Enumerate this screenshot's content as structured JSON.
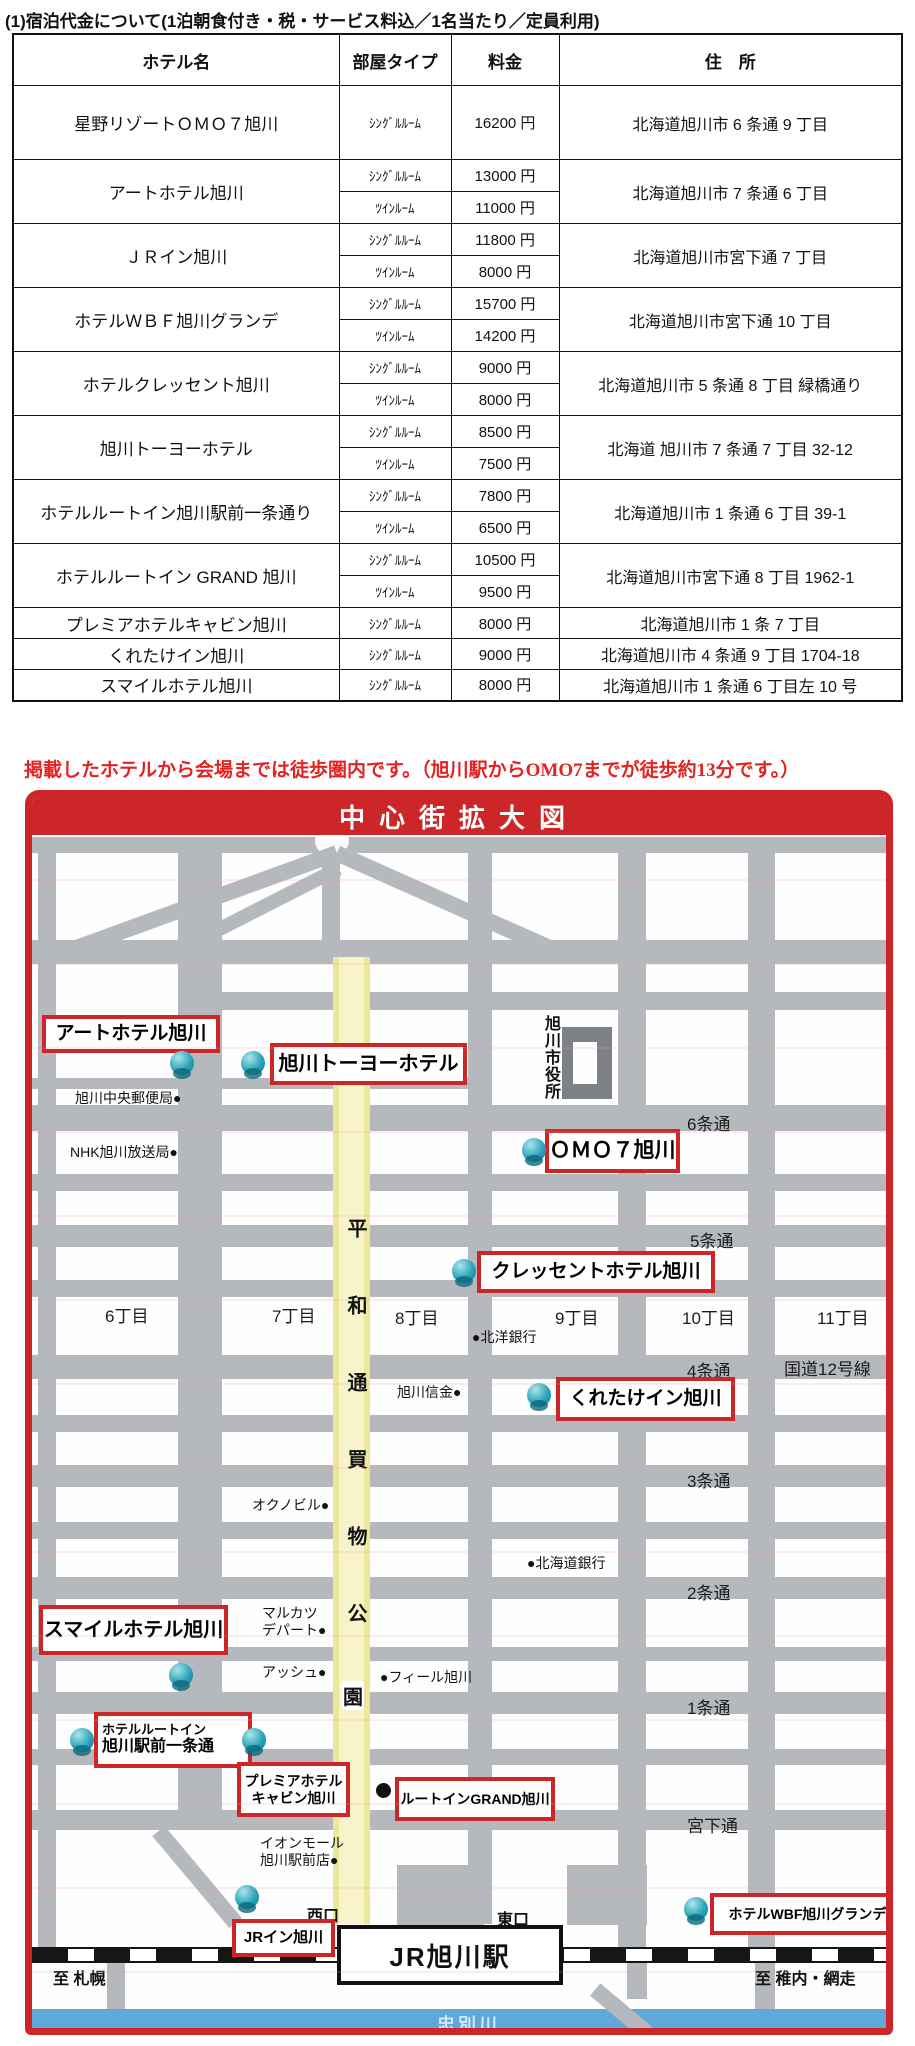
{
  "page": {
    "title": "(1)宿泊代金について(1泊朝食付き・税・サービス料込／1名当たり／定員利用)",
    "note": "掲載したホテルから会場までは徒歩圏内です。（旭川駅からOMO7までが徒歩約13分です。）"
  },
  "table": {
    "headers": {
      "hotel": "ホテル名",
      "room": "部屋タイプ",
      "price": "料金",
      "address": "住　所"
    },
    "rows": [
      {
        "name": "星野リゾートＯＭＯ７旭川",
        "types": [
          {
            "room": "ｼﾝｸﾞﾙﾙｰﾑ",
            "price": "16200 円"
          }
        ],
        "address": "北海道旭川市 6 条通 9 丁目"
      },
      {
        "name": "アートホテル旭川",
        "types": [
          {
            "room": "ｼﾝｸﾞﾙﾙｰﾑ",
            "price": "13000 円"
          },
          {
            "room": "ﾂｲﾝﾙｰﾑ",
            "price": "11000 円"
          }
        ],
        "address": "北海道旭川市 7 条通 6 丁目"
      },
      {
        "name": "ＪＲイン旭川",
        "types": [
          {
            "room": "ｼﾝｸﾞﾙﾙｰﾑ",
            "price": "11800 円"
          },
          {
            "room": "ﾂｲﾝﾙｰﾑ",
            "price": "8000 円"
          }
        ],
        "address": "北海道旭川市宮下通 7 丁目"
      },
      {
        "name": "ホテルＷＢＦ旭川グランデ",
        "types": [
          {
            "room": "ｼﾝｸﾞﾙﾙｰﾑ",
            "price": "15700 円"
          },
          {
            "room": "ﾂｲﾝﾙｰﾑ",
            "price": "14200 円"
          }
        ],
        "address": "北海道旭川市宮下通 10 丁目"
      },
      {
        "name": "ホテルクレッセント旭川",
        "types": [
          {
            "room": "ｼﾝｸﾞﾙﾙｰﾑ",
            "price": "9000 円"
          },
          {
            "room": "ﾂｲﾝﾙｰﾑ",
            "price": "8000 円"
          }
        ],
        "address": "北海道旭川市 5 条通 8 丁目  緑橋通り"
      },
      {
        "name": "旭川トーヨーホテル",
        "types": [
          {
            "room": "ｼﾝｸﾞﾙﾙｰﾑ",
            "price": "8500 円"
          },
          {
            "room": "ﾂｲﾝﾙｰﾑ",
            "price": "7500 円"
          }
        ],
        "address": "北海道  旭川市 7 条通 7 丁目 32-12"
      },
      {
        "name": "ホテルルートイン旭川駅前一条通り",
        "types": [
          {
            "room": "ｼﾝｸﾞﾙﾙｰﾑ",
            "price": "7800 円"
          },
          {
            "room": "ﾂｲﾝﾙｰﾑ",
            "price": "6500 円"
          }
        ],
        "address": "北海道旭川市 1 条通 6 丁目 39-1"
      },
      {
        "name": "ホテルルートイン GRAND 旭川",
        "types": [
          {
            "room": "ｼﾝｸﾞﾙﾙｰﾑ",
            "price": "10500 円"
          },
          {
            "room": "ﾂｲﾝﾙｰﾑ",
            "price": "9500 円"
          }
        ],
        "address": "北海道旭川市宮下通 8 丁目 1962-1"
      },
      {
        "name": "プレミアホテルキャビン旭川",
        "types": [
          {
            "room": "ｼﾝｸﾞﾙﾙｰﾑ",
            "price": "8000 円"
          }
        ],
        "address": "北海道旭川市 1 条 7 丁目"
      },
      {
        "name": "くれたけイン旭川",
        "types": [
          {
            "room": "ｼﾝｸﾞﾙﾙｰﾑ",
            "price": "9000 円"
          }
        ],
        "address": "北海道旭川市 4 条通 9 丁目 1704-18"
      },
      {
        "name": "スマイルホテル旭川",
        "types": [
          {
            "room": "ｼﾝｸﾞﾙﾙｰﾑ",
            "price": "8000 円"
          }
        ],
        "address": "北海道旭川市 1 条通 6 丁目左 10 号"
      }
    ]
  },
  "map": {
    "title": "中心街拡大図",
    "colors": {
      "accent_red": "#cd2629",
      "street_gray": "#b5b9bd",
      "mall_yellow": "#f3efa8",
      "river_blue": "#5fa8d8",
      "marker_teal": "#2ba3b8"
    },
    "labels": {
      "art": "アートホテル旭川",
      "toyo": "旭川トーヨーホテル",
      "omo": "ＯＭＯ７旭川",
      "crescent": "クレッセントホテル旭川",
      "kuretake": "くれたけイン旭川",
      "smile": "スマイルホテル旭川",
      "routeinn_line1": "ホテルルートイン",
      "routeinn_line2": "旭川駅前一条通",
      "premier_line1": "プレミアホテル",
      "premier_line2": "キャビン旭川",
      "grand": "ルートインGRAND旭川",
      "jrinn": "JRイン旭川",
      "wbf": "ホテルWBF旭川グランデ"
    },
    "pois": {
      "cityhall": "旭川市役所",
      "postoffice": "旭川中央郵便局●",
      "nhk": "NHK旭川放送局●",
      "hokuyo_bank": "●北洋銀行",
      "shinkin": "旭川信金●",
      "okuno_bldg": "オクノビル●",
      "hokkaido_bank": "●北海道銀行",
      "marukatsu_line1": "マルカツ",
      "marukatsu_line2": "デパート●",
      "ash": "アッシュ●",
      "feeeal": "●フィール旭川",
      "aeon_line1": "イオンモール",
      "aeon_line2": "旭川駅前店●"
    },
    "streets": {
      "jo6": "6条通",
      "jo5": "5条通",
      "jo4": "4条通",
      "jo3": "3条通",
      "jo2": "2条通",
      "jo1": "1条通",
      "miyashita": "宮下通",
      "route12": "国道12号線",
      "chome6": "6丁目",
      "chome7": "7丁目",
      "chome8": "8丁目",
      "chome9": "9丁目",
      "chome10": "10丁目",
      "chome11": "11丁目",
      "mall_upper": "平和通買物公",
      "mall_last": "園"
    },
    "station": {
      "name": "JR旭川駅",
      "west_gate": "西口",
      "east_gate": "東口",
      "to_sapporo": "至 札幌",
      "to_wakkanai": "至 稚内・網走"
    },
    "river": "忠別川"
  }
}
